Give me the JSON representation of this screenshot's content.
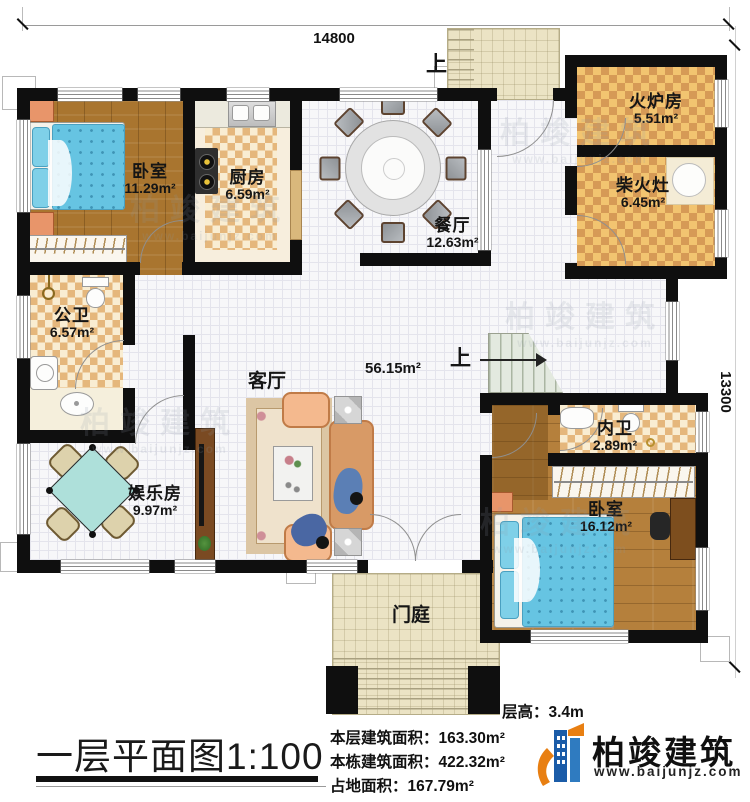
{
  "meta": {
    "title": "一层平面图1:100"
  },
  "dimensions": {
    "width_mm": "14800",
    "height_mm": "13300"
  },
  "stairs": {
    "up_label": "上"
  },
  "rooms": {
    "bedroom1": {
      "name": "卧室",
      "area": "11.29m²"
    },
    "kitchen": {
      "name": "厨房",
      "area": "6.59m²"
    },
    "dining": {
      "name": "餐厅",
      "area": "12.63m²"
    },
    "furnace": {
      "name": "火炉房",
      "area": "5.51m²"
    },
    "firewood_stove": {
      "name": "柴火灶",
      "area": "6.45m²"
    },
    "public_bathroom": {
      "name": "公卫",
      "area": "6.57m²"
    },
    "living": {
      "name": "客厅",
      "area": "56.15m²"
    },
    "entertainment": {
      "name": "娱乐房",
      "area": "9.97m²"
    },
    "inner_bathroom": {
      "name": "内卫",
      "area": "2.89m²"
    },
    "bedroom2": {
      "name": "卧室",
      "area": "16.12m²"
    },
    "foyer": {
      "name": "门庭"
    }
  },
  "stats": {
    "floor_height": "层高：3.4m",
    "this_floor_area": "本层建筑面积：163.30m²",
    "building_total_area": "本栋建筑面积：422.32m²",
    "footprint_area": "占地面积：167.79m²"
  },
  "brand": {
    "name": "柏竣建筑",
    "website": "www.baijunjz.com"
  },
  "colors": {
    "wall": "#0f0f0f",
    "brand_blue": "#1b5ca8",
    "brand_orange": "#e87f12"
  }
}
